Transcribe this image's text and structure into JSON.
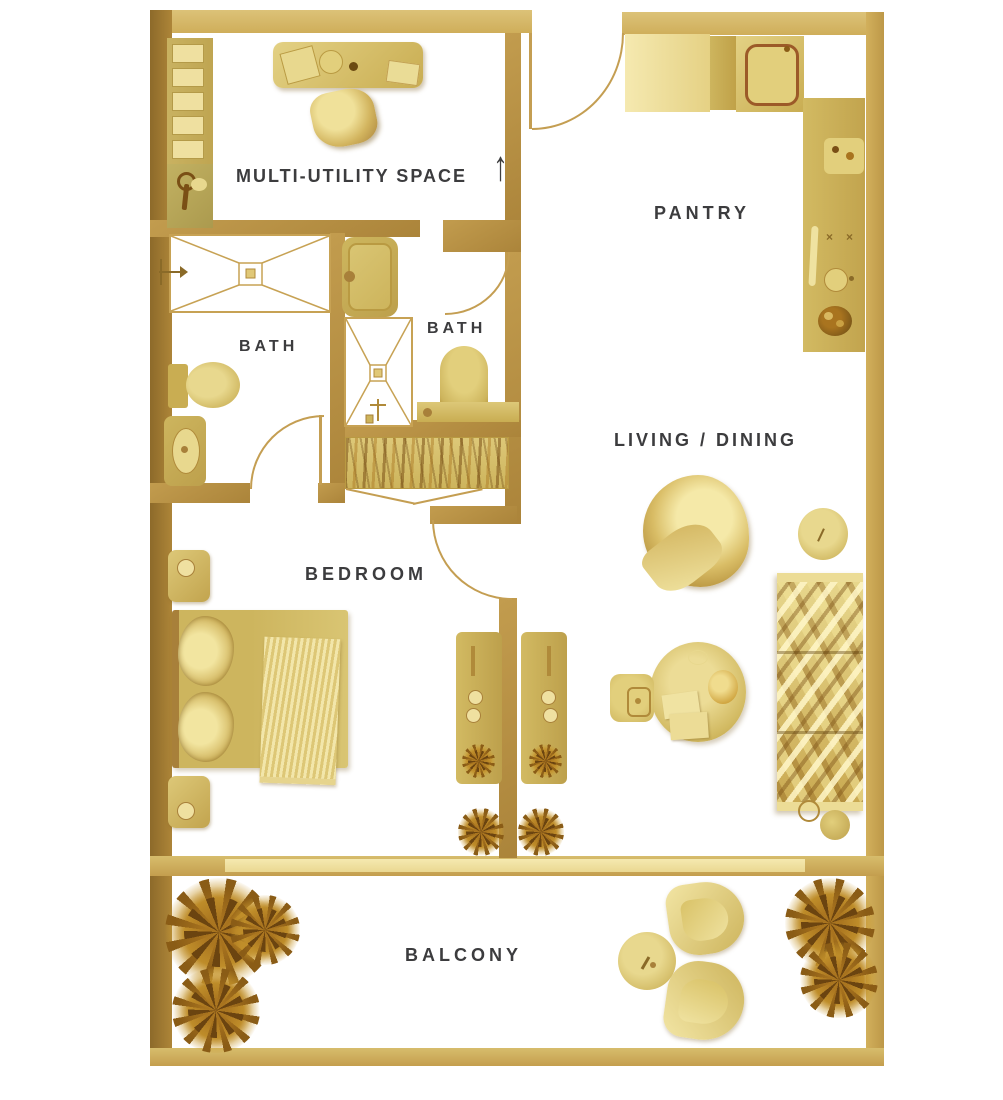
{
  "floorplan": {
    "rooms": {
      "multi_utility": {
        "label": "MULTI-UTILITY SPACE"
      },
      "pantry": {
        "label": "PANTRY"
      },
      "bath_left": {
        "label": "BATH"
      },
      "bath_right": {
        "label": "BATH"
      },
      "living_dining": {
        "label": "LIVING / DINING"
      },
      "bedroom": {
        "label": "BEDROOM"
      },
      "balcony": {
        "label": "BALCONY"
      }
    },
    "entry": {
      "arrow_glyph": "↑"
    },
    "icons": {
      "burner_knob_glyph": "×"
    },
    "colors": {
      "wall_gold": "#c2a052",
      "wall_gold_dark": "#8f6c2b",
      "wall_gold_light": "#d6bc6e",
      "furniture_gold": "#d8c26e",
      "furniture_gold_light": "#f0e3a6",
      "plant_brown": "#8a5c16",
      "label_text": "#3c3c3e",
      "floor_white": "#ffffff"
    }
  }
}
